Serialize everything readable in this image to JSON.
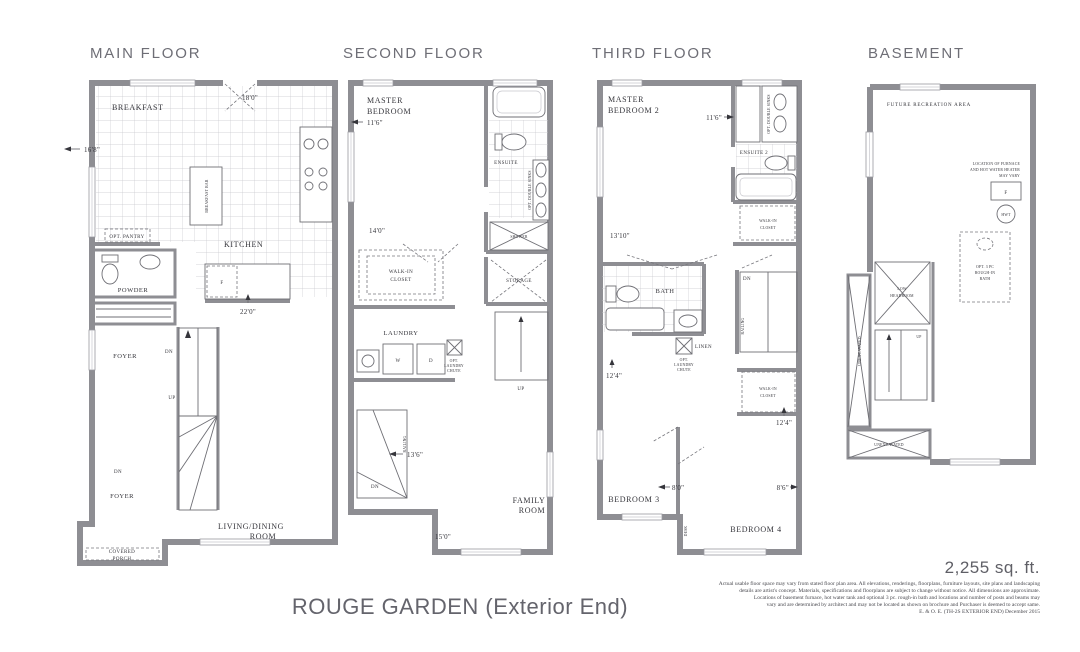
{
  "meta": {
    "sqft": "2,255 sq. ft.",
    "plan_title": "ROUGE GARDEN (Exterior End)",
    "disclaimer": [
      "Actual usable floor space may vary from stated floor plan area. All elevations, renderings, floorplans, furniture layouts, site plans and landscaping",
      "details are artist's concept. Materials, specifications and floorplans are subject to change without notice. All dimensions are approximate.",
      "Locations of basement furnace, hot water tank and optional 3 pc. rough-in bath and locations and number of posts and beams may",
      "vary and are determined by architect and may not be located as shown on brochure and Purchaser is deemed to accept same.",
      "E. & O. E. (TH-2S EXTERIOR END) December 2015"
    ]
  },
  "main": {
    "title": "MAIN FLOOR",
    "breakfast": "BREAKFAST",
    "dim_breakfast_width": "16'8\"",
    "dim_breakfast_door": "18'0\"",
    "breakfast_bar": "BREAKFAST BAR",
    "opt_pantry": "OPT. PANTRY",
    "kitchen": "KITCHEN",
    "fridge": "F",
    "dim_kitchen": "22'0\"",
    "powder": "POWDER",
    "foyer_upper": "FOYER",
    "dn_upper": "DN",
    "up": "UP",
    "dn_lower": "DN",
    "foyer_lower": "FOYER",
    "covered_porch": [
      "COVERED",
      "PORCH"
    ],
    "living_dining": [
      "LIVING/DINING",
      "ROOM"
    ]
  },
  "second": {
    "title": "SECOND FLOOR",
    "master_bedroom": [
      "MASTER",
      "BEDROOM"
    ],
    "dim_master_width": "11'6\"",
    "dim_master_length": "14'0\"",
    "ensuite": "ENSUITE",
    "opt_double_sinks": "OPT. DOUBLE SINKS",
    "shower": "SHOWER",
    "walk_in_closet": [
      "WALK-IN",
      "CLOSET"
    ],
    "laundry": "LAUNDRY",
    "washer": "W",
    "dryer": "D",
    "opt_laundry_chute": [
      "OPT.",
      "LAUNDRY",
      "CHUTE"
    ],
    "storage": "STORAGE",
    "up": "UP",
    "railing": "RAILING",
    "dim_stair": "13'6\"",
    "dn": "DN",
    "family_room": [
      "FAMILY",
      "ROOM"
    ],
    "dim_family": "15'0\""
  },
  "third": {
    "title": "THIRD FLOOR",
    "master_bedroom_2": [
      "MASTER",
      "BEDROOM 2"
    ],
    "dim_master2_width": "11'6\"",
    "dim_master2_length": "13'10\"",
    "opt_double_sinks": "OPT. DOUBLE SINKS",
    "ensuite_2": "ENSUITE 2",
    "walk_in_closet_upper": [
      "WALK-IN",
      "CLOSET"
    ],
    "bath": "BATH",
    "linen": "LINEN",
    "opt_laundry_chute": [
      "OPT.",
      "LAUNDRY",
      "CHUTE"
    ],
    "dim_hall": "12'4\"",
    "dn": "DN",
    "railing": "RAILING",
    "walk_in_closet_lower": [
      "WALK-IN",
      "CLOSET"
    ],
    "dim_closet": "12'4\"",
    "bedroom_3": "BEDROOM 3",
    "dim_bedroom3": "8'0\"",
    "desk": "DESK",
    "bedroom_4": "BEDROOM 4",
    "dim_bedroom4": "8'6\""
  },
  "basement": {
    "title": "BASEMENT",
    "future_recreation": "FUTURE RECREATION AREA",
    "furnace_note": [
      "LOCATION OF FURNACE",
      "AND HOT WATER HEATER",
      "MAY VARY"
    ],
    "furnace": "F",
    "hwt": "HWT",
    "opt_bath": [
      "OPT. 3 PC",
      "ROUGH-IN",
      "BATH"
    ],
    "low_headroom": [
      "LOW",
      "HEADROOM"
    ],
    "up": "UP",
    "unexcavated_left": "UNEXCAVATED",
    "unexcavated_bottom": "UNEXCAVATED"
  }
}
